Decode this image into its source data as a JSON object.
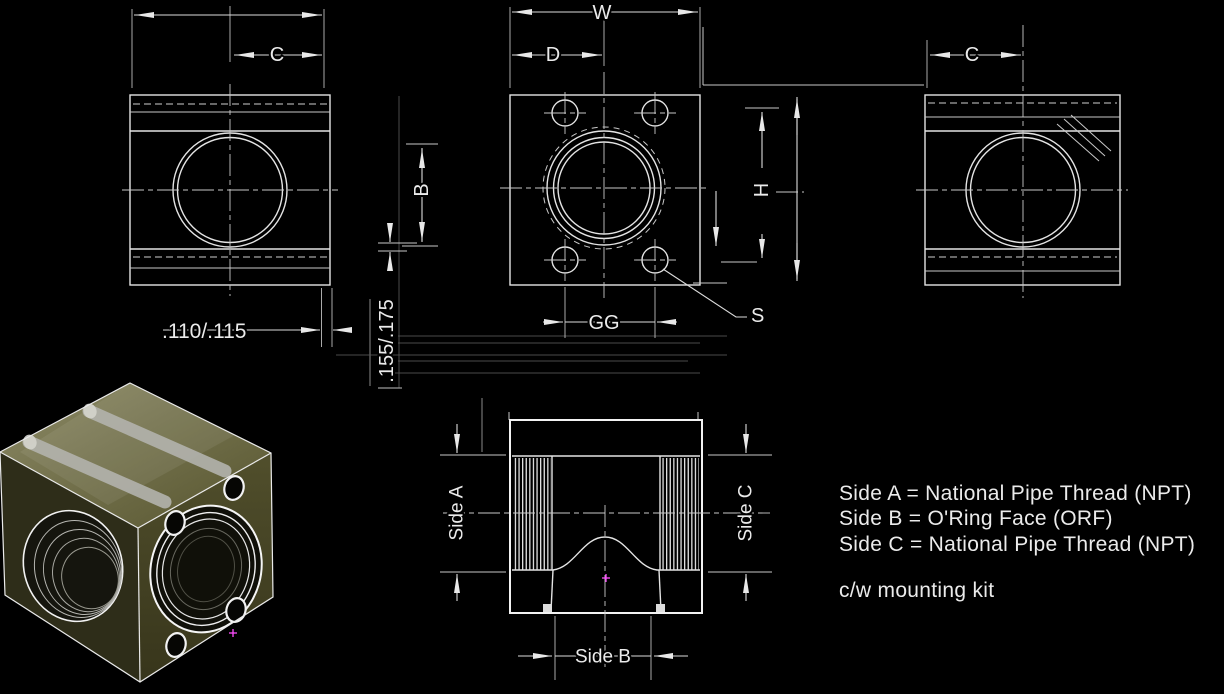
{
  "title": "pipe-block-engineering-drawing",
  "labels": {
    "dim_c_left": "C",
    "dim_w": "W",
    "dim_d": "D",
    "dim_c_right": "C",
    "dim_b": "B",
    "dim_h": "H",
    "dim_gg": "GG",
    "dim_s": "S",
    "dim_110_115": ".110/.115",
    "dim_155_175": ".155/.175",
    "side_a": "Side A",
    "side_b": "Side B",
    "side_c": "Side C"
  },
  "notes": {
    "line1": "Side A = National Pipe Thread (NPT)",
    "line2": "Side B = O'Ring Face (ORF)",
    "line3": "Side C = National Pipe Thread (NPT)",
    "line4": "c/w mounting kit"
  },
  "colors": {
    "background": "#000000",
    "line": "#e8e8e8",
    "centerline": "#c9c9c9",
    "model_top": "#6e6c4a",
    "model_left": "#2e2d19",
    "model_right": "#43411f",
    "center_mark": "#ff4dff"
  }
}
